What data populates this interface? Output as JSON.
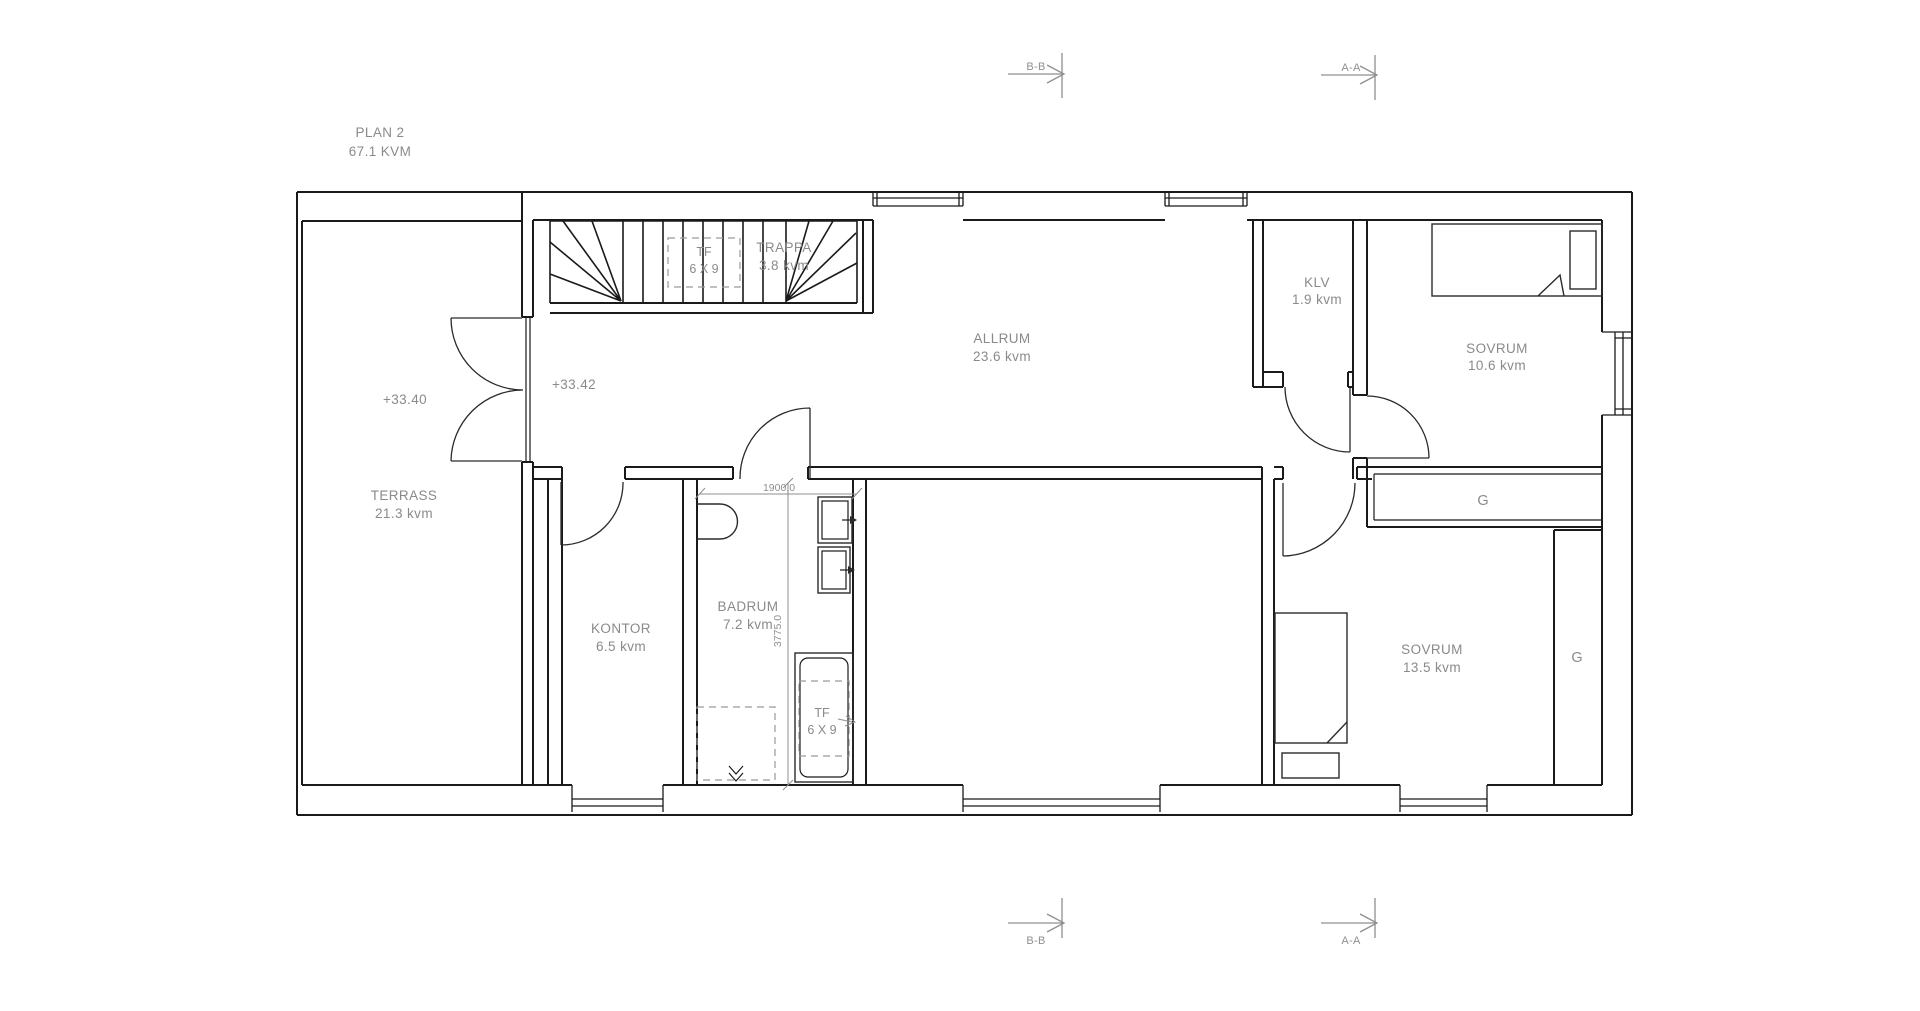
{
  "colors": {
    "background": "#ffffff",
    "wall_line": "#1a1a1a",
    "label_gray": "#8a8a8a",
    "annotation_gray": "#8f8f8f"
  },
  "title": {
    "name": "PLAN 2",
    "area": "67.1 KVM"
  },
  "rooms": {
    "terrass": {
      "name": "TERRASS",
      "area": "21.3 kvm"
    },
    "kontor": {
      "name": "KONTOR",
      "area": "6.5 kvm"
    },
    "badrum": {
      "name": "BADRUM",
      "area": "7.2 kvm"
    },
    "allrum": {
      "name": "ALLRUM",
      "area": "23.6 kvm"
    },
    "trappa": {
      "name": "TRAPPA",
      "area": "3.8 kvm"
    },
    "klv": {
      "name": "KLV",
      "area": "1.9 kvm"
    },
    "sovrum_top": {
      "name": "SOVRUM",
      "area": "10.6 kvm"
    },
    "sovrum_bottom": {
      "name": "SOVRUM",
      "area": "13.5 kvm"
    }
  },
  "skylights": {
    "stairs": {
      "line1": "TF",
      "line2": "6 X 9"
    },
    "bathroom": {
      "line1": "TF",
      "line2": "6 X 9"
    }
  },
  "wardrobes": {
    "top": "G",
    "right": "G"
  },
  "elevations": {
    "terrass": "+33.40",
    "allrum": "+33.42"
  },
  "dimensions": {
    "badrum_width": "1900.0",
    "badrum_height": "3775.0"
  },
  "section_markers": {
    "bb": "B-B",
    "aa": "A-A"
  }
}
